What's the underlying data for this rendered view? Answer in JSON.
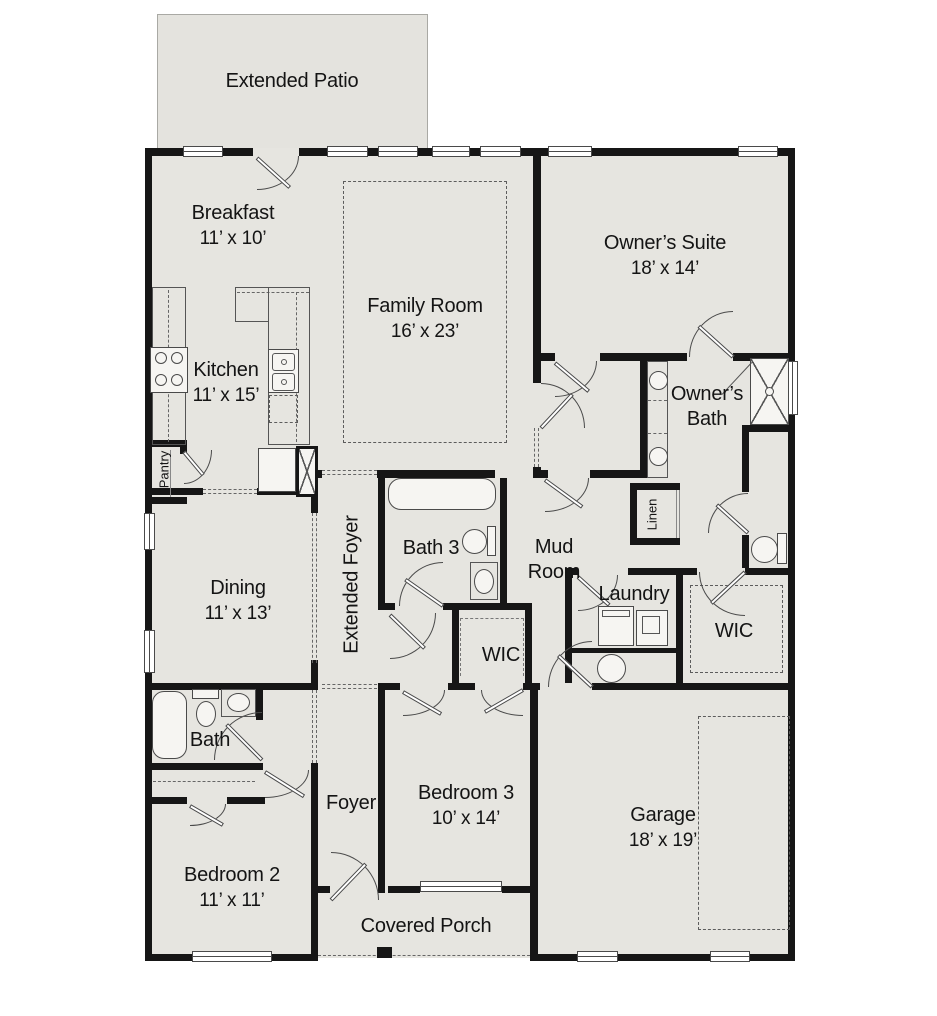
{
  "palette": {
    "background": "#ffffff",
    "floor": "#e6e5e0",
    "wall": "#161616",
    "line": "#4a4a4a"
  },
  "plan": {
    "patio": {
      "label": "Extended Patio"
    },
    "breakfast": {
      "label": "Breakfast",
      "dims": "11’ x 10’"
    },
    "family_room": {
      "label": "Family Room",
      "dims": "16’ x 23’"
    },
    "owners_suite": {
      "label": "Owner’s Suite",
      "dims": "18’ x 14’"
    },
    "kitchen": {
      "label": "Kitchen",
      "dims": "11’ x 15’"
    },
    "pantry": {
      "label": "Pantry"
    },
    "dining": {
      "label": "Dining",
      "dims": "11’ x 13’"
    },
    "extended_foyer": {
      "label": "Extended Foyer"
    },
    "bath3": {
      "label": "Bath 3"
    },
    "mud_room": {
      "label": "Mud Room"
    },
    "linen": {
      "label": "Linen"
    },
    "laundry": {
      "label": "Laundry"
    },
    "owners_bath": {
      "label": "Owner’s Bath"
    },
    "owners_wic": {
      "label": "WIC"
    },
    "bed3_wic": {
      "label": "WIC"
    },
    "bath2": {
      "label": "Bath"
    },
    "bedroom2": {
      "label": "Bedroom 2",
      "dims": "11’ x 11’"
    },
    "foyer": {
      "label": "Foyer"
    },
    "bedroom3": {
      "label": "Bedroom 3",
      "dims": "10’ x 14’"
    },
    "garage": {
      "label": "Garage",
      "dims": "18’ x 19’"
    },
    "covered_porch": {
      "label": "Covered Porch"
    }
  }
}
